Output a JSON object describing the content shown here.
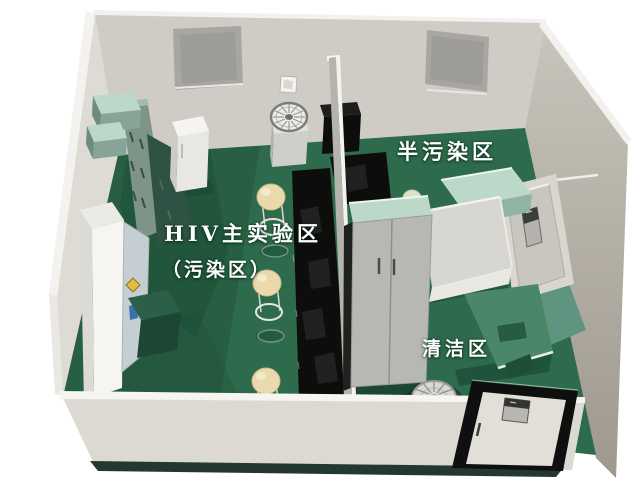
{
  "zones": {
    "main_lab": {
      "label": "HIV主实验区",
      "sublabel": "（污染区）"
    },
    "semi_contaminated": {
      "label": "半污染区"
    },
    "clean": {
      "label": "清洁区"
    }
  },
  "palette": {
    "floor_green": "#2e6b4c",
    "corridor_teal": "#5f9480",
    "bench_black": "#0d0d0c",
    "wall_back": "#cfccc5",
    "wall_left": "#dedbd4",
    "wall_front": "#dcd9d2",
    "desk_green": "#4a8769",
    "cabinet_mint": "#bcd8c8",
    "stool_cream": "#e9d9ac",
    "door_frame_black": "#0f0f0f",
    "label_text": "#ffffff"
  }
}
